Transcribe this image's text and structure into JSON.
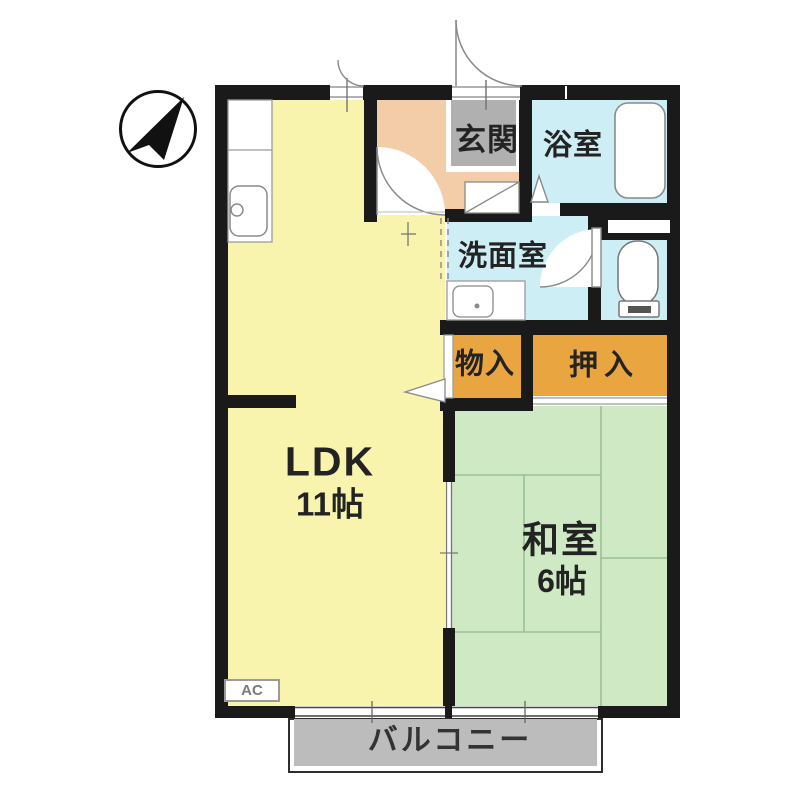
{
  "compass": {
    "icon": "north-arrow-icon"
  },
  "rooms": {
    "ldk": {
      "label": "LDK",
      "size": "11帖"
    },
    "washitsu": {
      "label": "和室",
      "size": "6帖"
    },
    "genkan": {
      "label": "玄関"
    },
    "bathroom": {
      "label": "浴室"
    },
    "washroom": {
      "label": "洗面室"
    },
    "storage": {
      "label": "物入"
    },
    "closet": {
      "label": "押入"
    },
    "balcony": {
      "label": "バルコニー"
    },
    "ac_unit": {
      "label": "AC"
    }
  },
  "colors": {
    "wall": "#1a1a1a",
    "ldk": "#f9f4ad",
    "hall": "#f3cda7",
    "tile": "#b0b0b0",
    "wet": "#cdeef5",
    "closet": "#e9a540",
    "tatami": "#cfe9c5",
    "tatami_line": "#9cbf96",
    "balcony": "#bcbcbc",
    "label": "#232323",
    "fixture": "#8a8a8a"
  }
}
